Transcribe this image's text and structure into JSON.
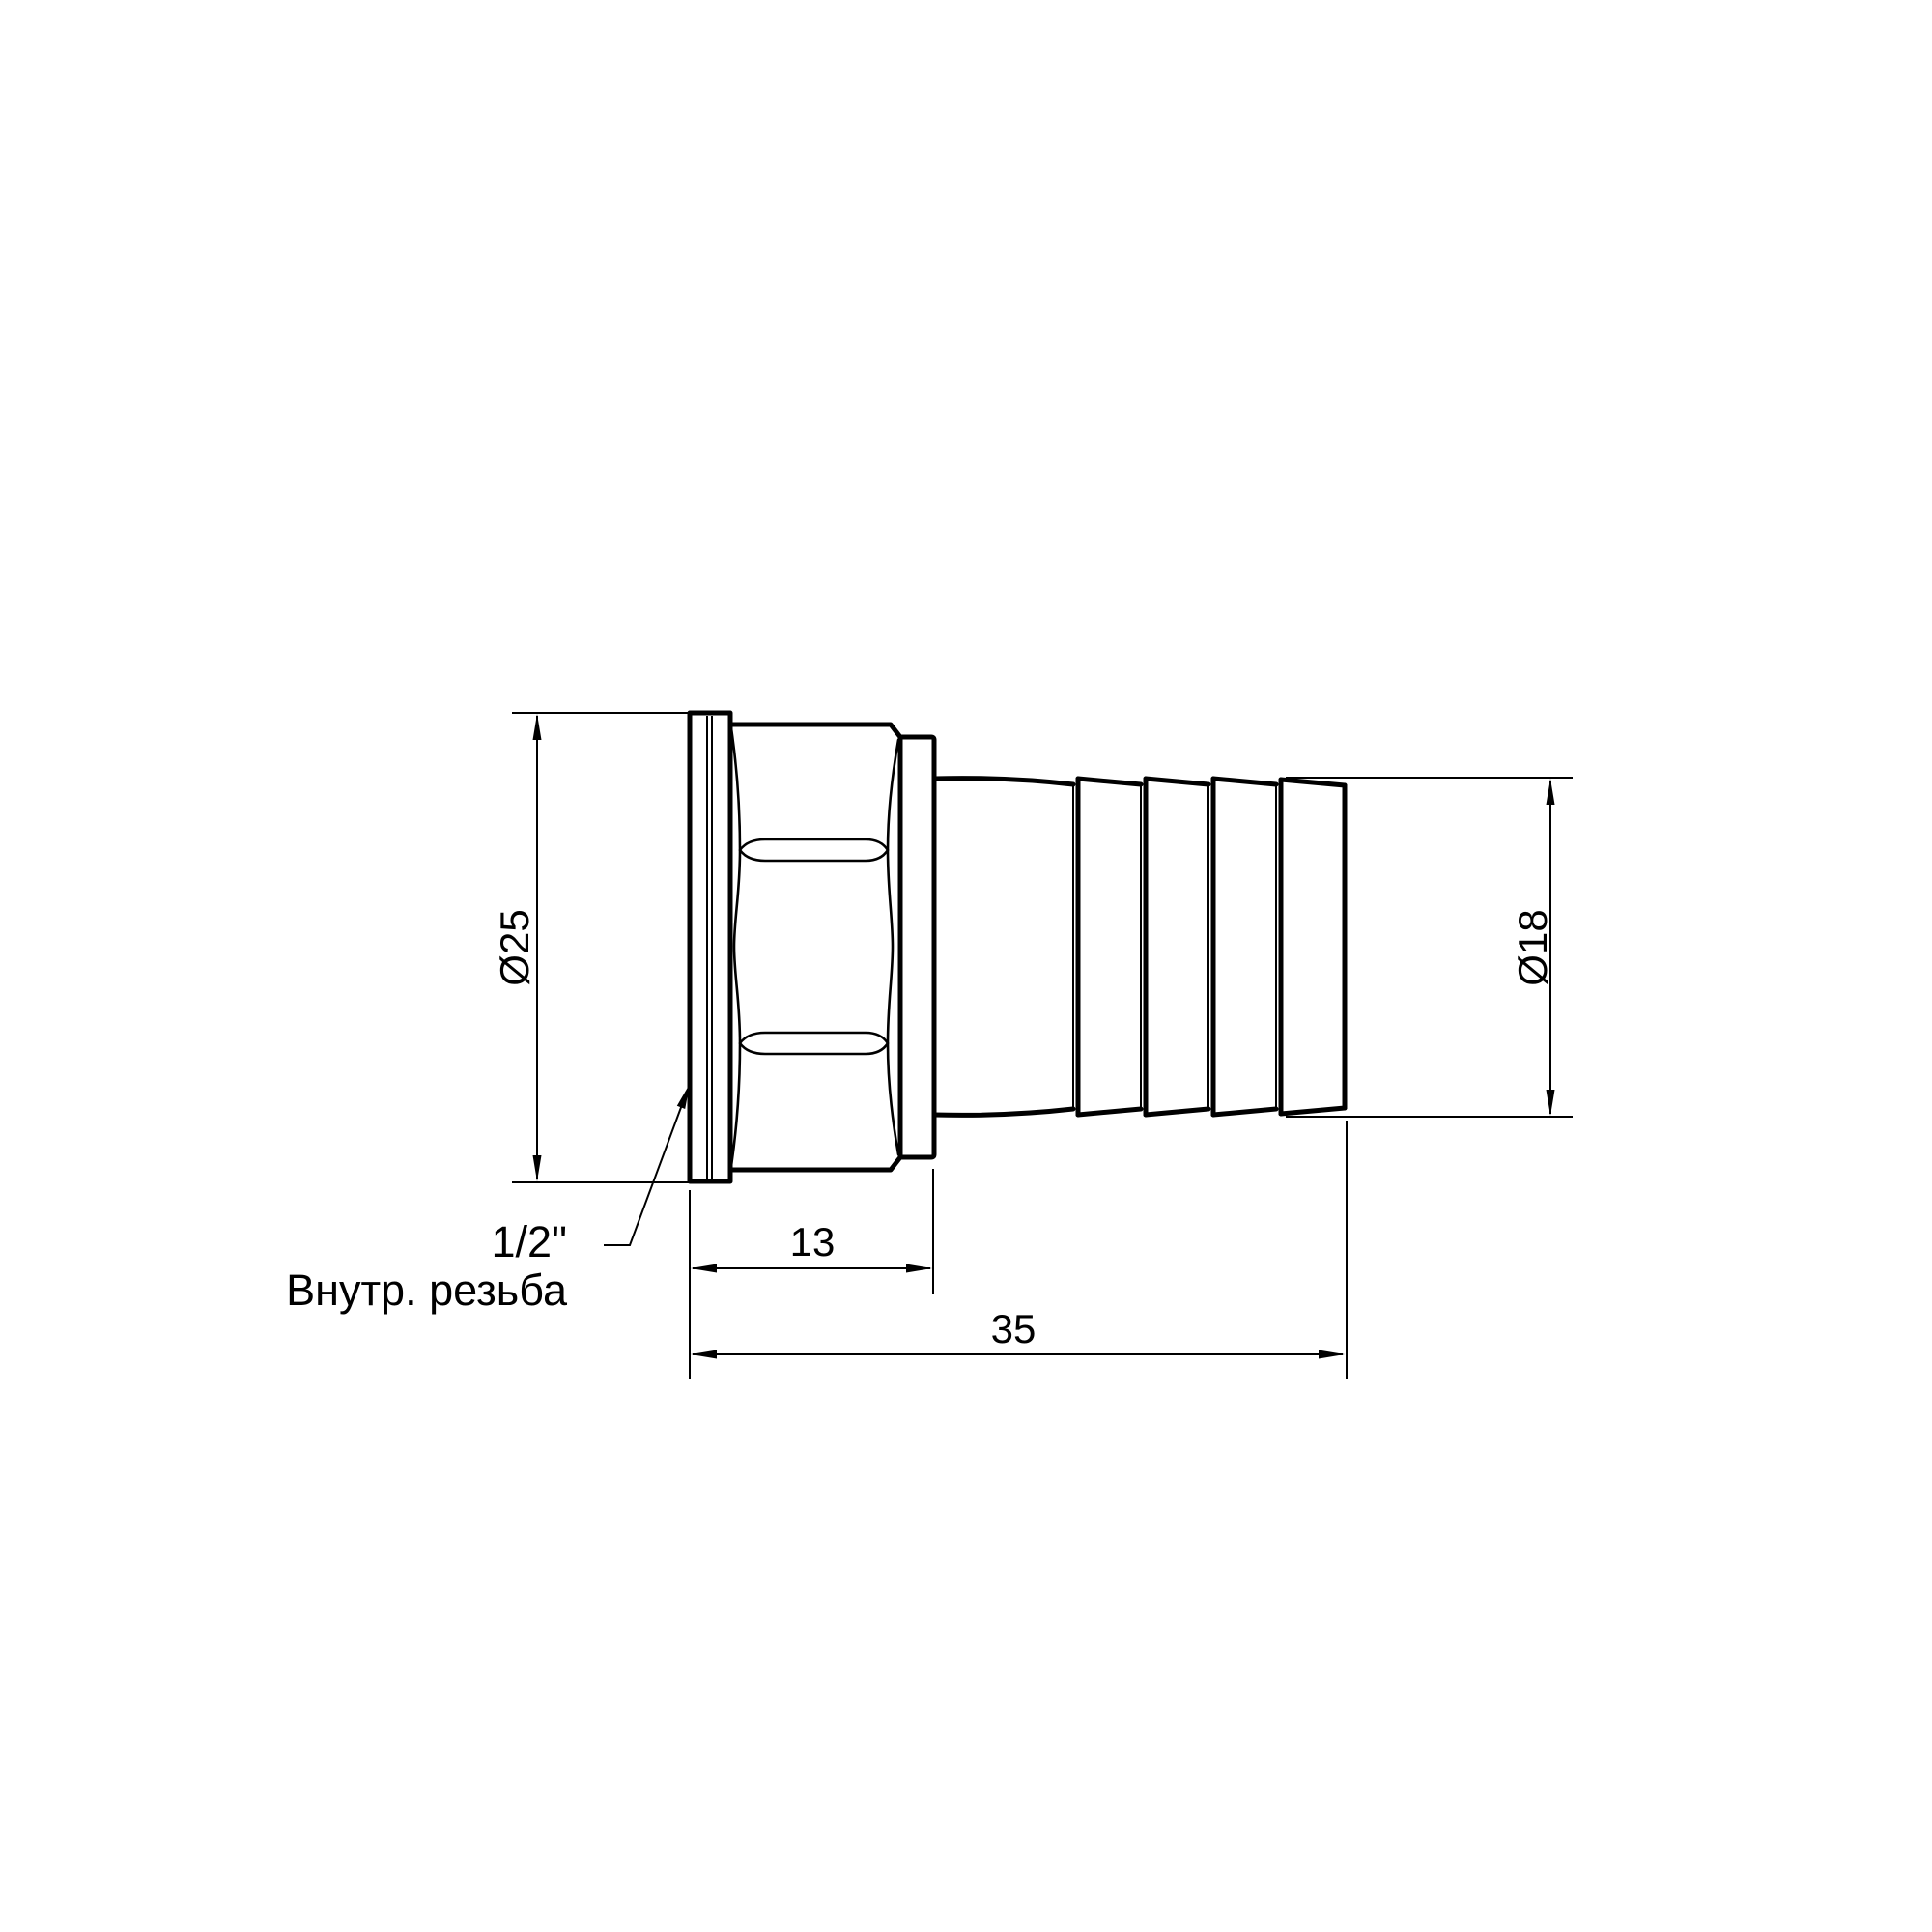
{
  "drawing": {
    "background": "#ffffff",
    "line_color": "#000000",
    "annotations": {
      "dia_outer": "Ø25",
      "dia_barb": "Ø18",
      "len_thread": "13",
      "len_total": "35",
      "thread_size": "1/2\"",
      "thread_type": "Внутр. резьба"
    }
  }
}
